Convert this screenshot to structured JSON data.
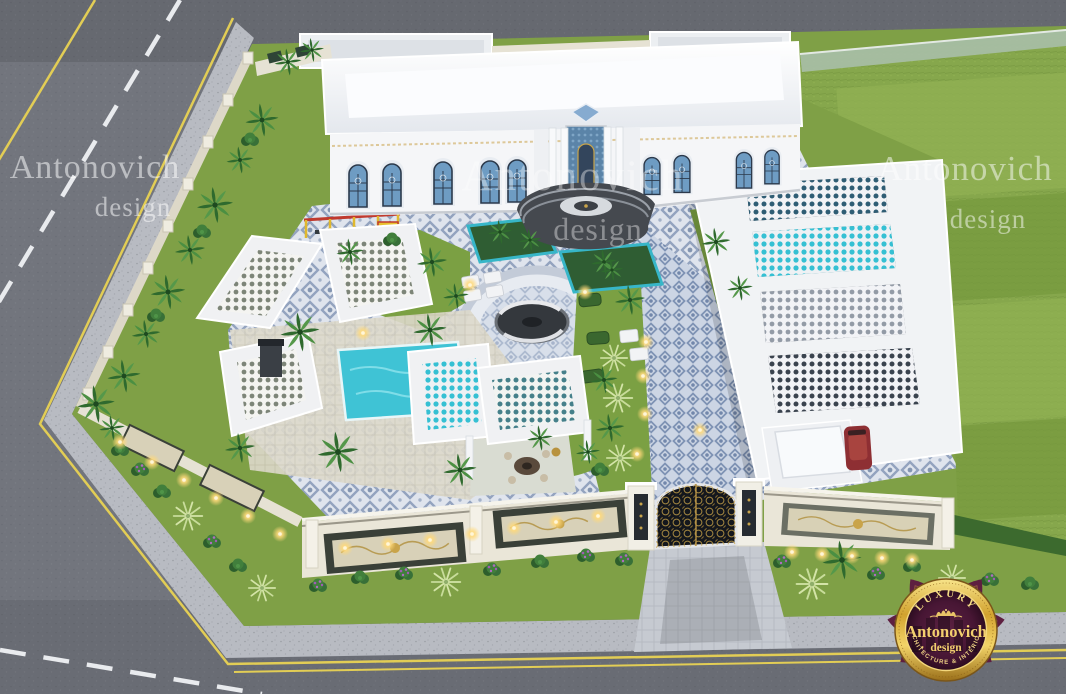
{
  "scene": {
    "type": "3d-architectural-render",
    "description": "Aerial view of a luxury white classical villa compound with tiled courtyard, pool pavilion, pergolas, ornate gate and landscaped gardens beside asphalt roads"
  },
  "watermarks": [
    {
      "line1": "Antonovich",
      "line2": "design"
    },
    {
      "line1": "Antonovich",
      "line2": "design"
    },
    {
      "line1": "Antonovich",
      "line2": "design"
    }
  ],
  "logo_badge": {
    "arc_top": "LUXURY",
    "name": "Antonovich",
    "name2": "design",
    "dot": "·",
    "arc_bottom": "ARCHITECTURE & INTERIORS"
  },
  "palette": {
    "road": "#72757d",
    "sidewalk": "#b8bbc2",
    "curb_yellow": "#e2cd55",
    "lane_white": "#e9ebee",
    "lawn": "#86a74c",
    "courtyard_grass": "#7ba043",
    "villa_white": "#f3f4f6",
    "window_blue": "#6e9cc3",
    "tile_base": "#dfe4ed",
    "tile_motif": "#93a3bf",
    "pool_turquoise": "#35c0d3",
    "wall_cream": "#eae6d8",
    "panel_dark": "#3a4038",
    "gate_black": "#14171d",
    "ornament_gold": "#c9a44a",
    "logo_maroon": "#5e1f40",
    "logo_gold": "#f2cf6e",
    "light_glow": "#ffd97a"
  }
}
